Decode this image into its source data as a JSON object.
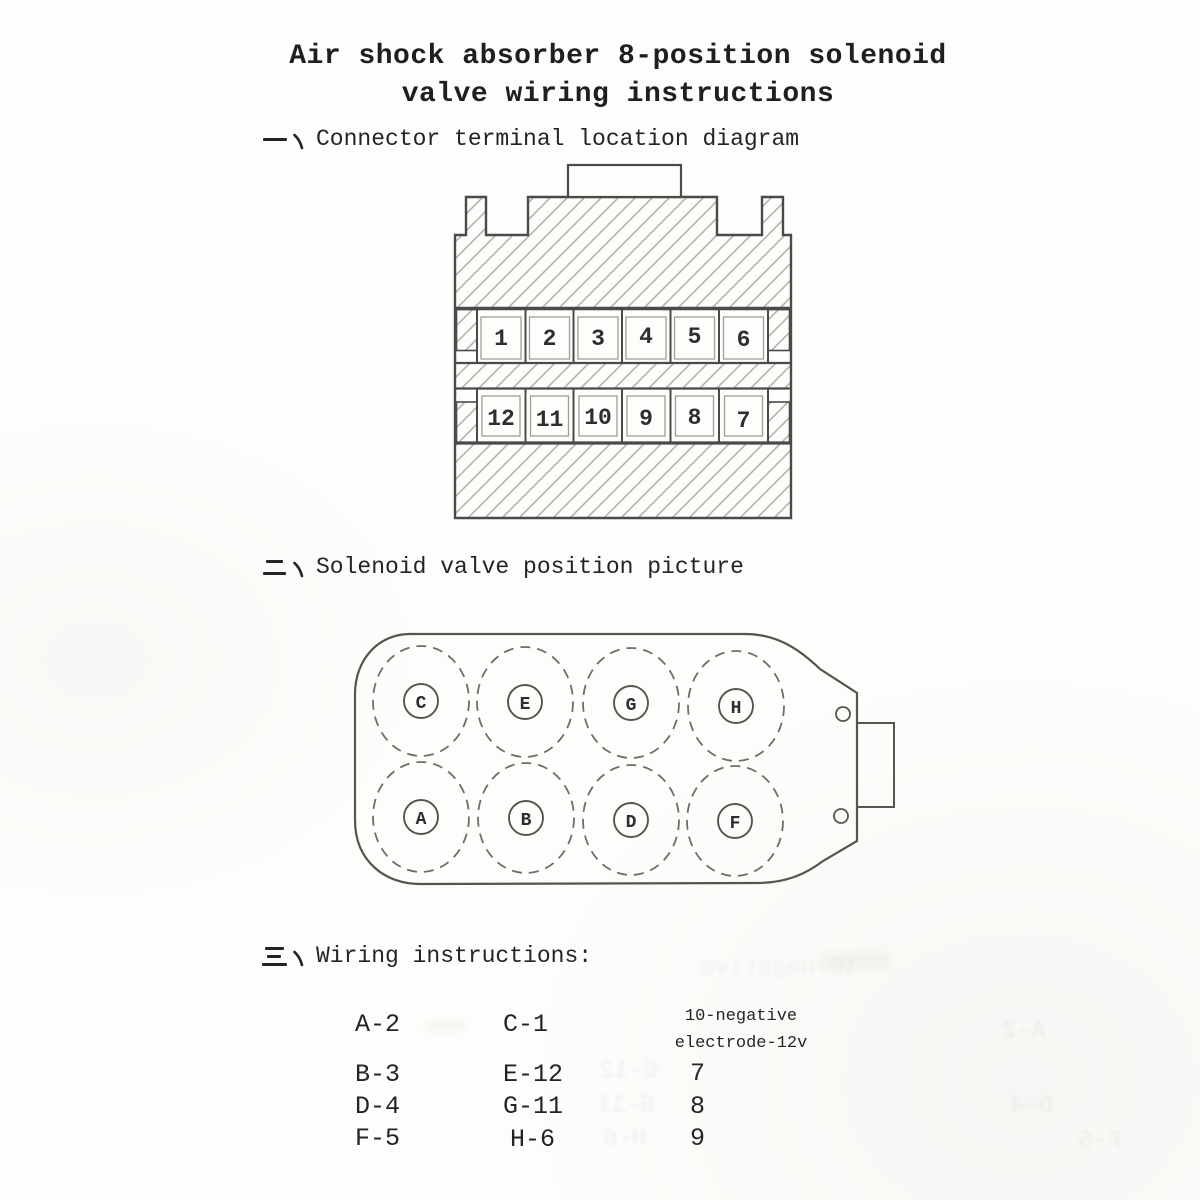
{
  "title": {
    "line1": "Air shock absorber 8-position solenoid",
    "line2": "valve wiring instructions"
  },
  "sections": {
    "one": {
      "numeral": "一",
      "label": "Connector terminal location diagram"
    },
    "two": {
      "numeral": "二",
      "label": "Solenoid valve position picture"
    },
    "three": {
      "numeral": "三",
      "label": "Wiring instructions:"
    }
  },
  "connector": {
    "terminals_top": [
      "1",
      "2",
      "3",
      "4",
      "5",
      "6"
    ],
    "terminals_bottom": [
      "12",
      "11",
      "10",
      "9",
      "8",
      "7"
    ]
  },
  "valve": {
    "positions_top": [
      "C",
      "E",
      "G",
      "H"
    ],
    "positions_bottom": [
      "A",
      "B",
      "D",
      "F"
    ]
  },
  "wiring": {
    "column1": [
      "A-2",
      "B-3",
      "D-4",
      "F-5"
    ],
    "column2": [
      "C-1",
      "E-12",
      "G-11",
      "H-6"
    ],
    "column3_header_line1": "10-negative",
    "column3_header_line2": "electrode-12v",
    "column3": [
      "7",
      "8",
      "9"
    ]
  },
  "colors": {
    "paper": "#fdfdfb",
    "ink": "#242424",
    "drawing_line": "#4a4a48",
    "hatch_line": "#b4b4ae"
  }
}
